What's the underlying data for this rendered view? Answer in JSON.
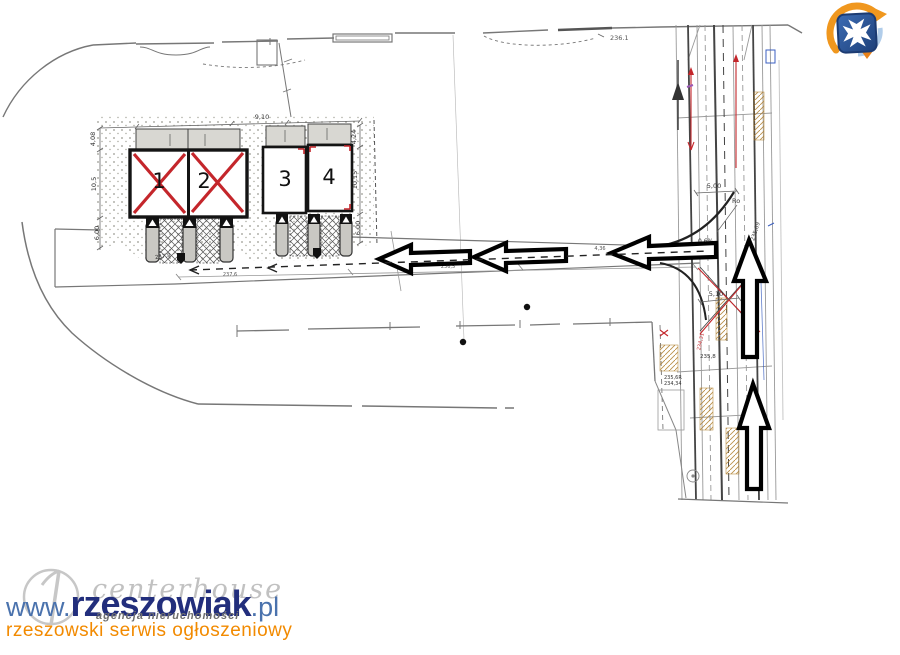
{
  "watermark": {
    "prefix": "www.",
    "brand": "rzeszowiak",
    "suffix": ".pl",
    "tagline": "rzeszowski serwis ogłoszeniowy",
    "agency_name": "centerhouse",
    "agency_tagline": "agencja nieruchomości",
    "colors": {
      "link_blue": "#4a72ad",
      "brand_navy": "#222e7c",
      "tagline_orange": "#f28a00",
      "agency_gray": "#8f8f8f"
    }
  },
  "crest": {
    "name": "rzeszow-city-crest",
    "colors": {
      "shield_blue": "#2f5da8",
      "swoosh_orange": "#f0971e",
      "swoosh_light_blue": "#a8c8e8",
      "cross_white": "#ffffff"
    }
  },
  "plan": {
    "units": [
      {
        "number": "1",
        "status": "crossed-out"
      },
      {
        "number": "2",
        "status": "crossed-out"
      },
      {
        "number": "3",
        "status": "available"
      },
      {
        "number": "4",
        "status": "available"
      }
    ],
    "colors": {
      "cross_red": "#c4262b",
      "line_gray": "#777777",
      "dark": "#1a1a1a",
      "tan": "#d9b98a"
    },
    "arrows": {
      "left_count": 3,
      "up_count": 2
    },
    "annotations": {
      "elevation_top": "236.1",
      "dim_top": "9,10",
      "dim_left_1": "4,08",
      "dim_left_2": "10,5",
      "dim_left_3": "6,00",
      "dim_right_1": "4,24",
      "dim_right_2": "10,15",
      "dim_right_3": "6,00",
      "dim_junction": "5,00",
      "radius_label": "Ro",
      "slope": "0,6%",
      "elevation_road_rot": "235,69",
      "dim_junction_2": "5,10",
      "elevation_marker": "237,8",
      "road_note_0": "237,6",
      "road_note_1": "236,5",
      "road_note_2": "4,36",
      "corridor_1": "235,8",
      "corridor_2": "235,6R",
      "corridor_3": "234,34",
      "corridor_red_rot": "234,31"
    }
  }
}
